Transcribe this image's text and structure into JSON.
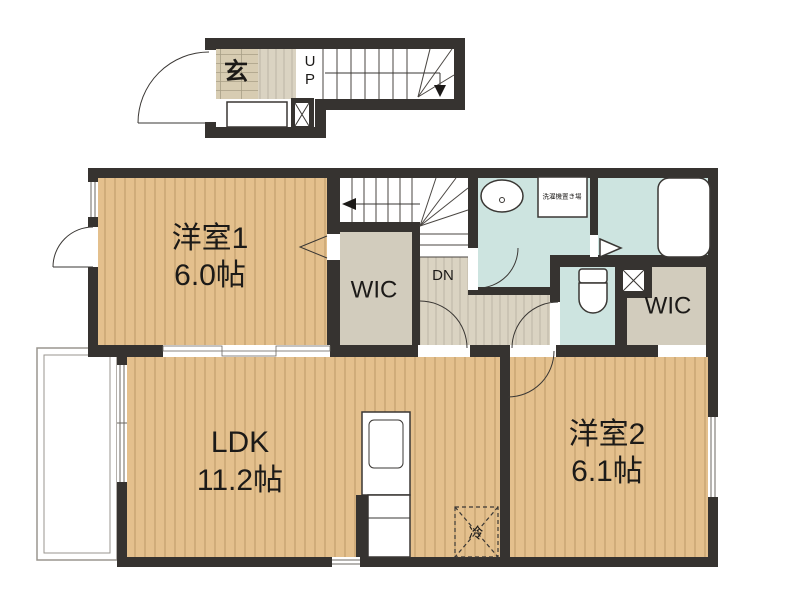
{
  "first_floor": {
    "entrance_label": "玄",
    "up_letters": [
      "U",
      "P"
    ]
  },
  "second_floor": {
    "room1_name": "洋室1",
    "room1_size": "6.0帖",
    "wic1_label": "WIC",
    "stairs_down_label": "DN",
    "laundry_label": "洗濯機置き場",
    "wic2_label": "WIC",
    "ldk_name": "LDK",
    "ldk_size": "11.2帖",
    "room2_name": "洋室2",
    "room2_size": "6.1帖",
    "fridge_label": "冷"
  },
  "colors": {
    "wall": "#363330",
    "wood_floor": "#e4c08d",
    "wood_grain_line": "#b3905f",
    "hall_floor": "#dad3c2",
    "hall_grain_line": "#b5afa0",
    "entrance_tile": "#d7ccb2",
    "wic_fill": "#d2ccbd",
    "wet_room_fill": "#cde4e0",
    "balcony_border": "#9a968f",
    "background": "#ffffff",
    "text": "#1c1a18"
  }
}
